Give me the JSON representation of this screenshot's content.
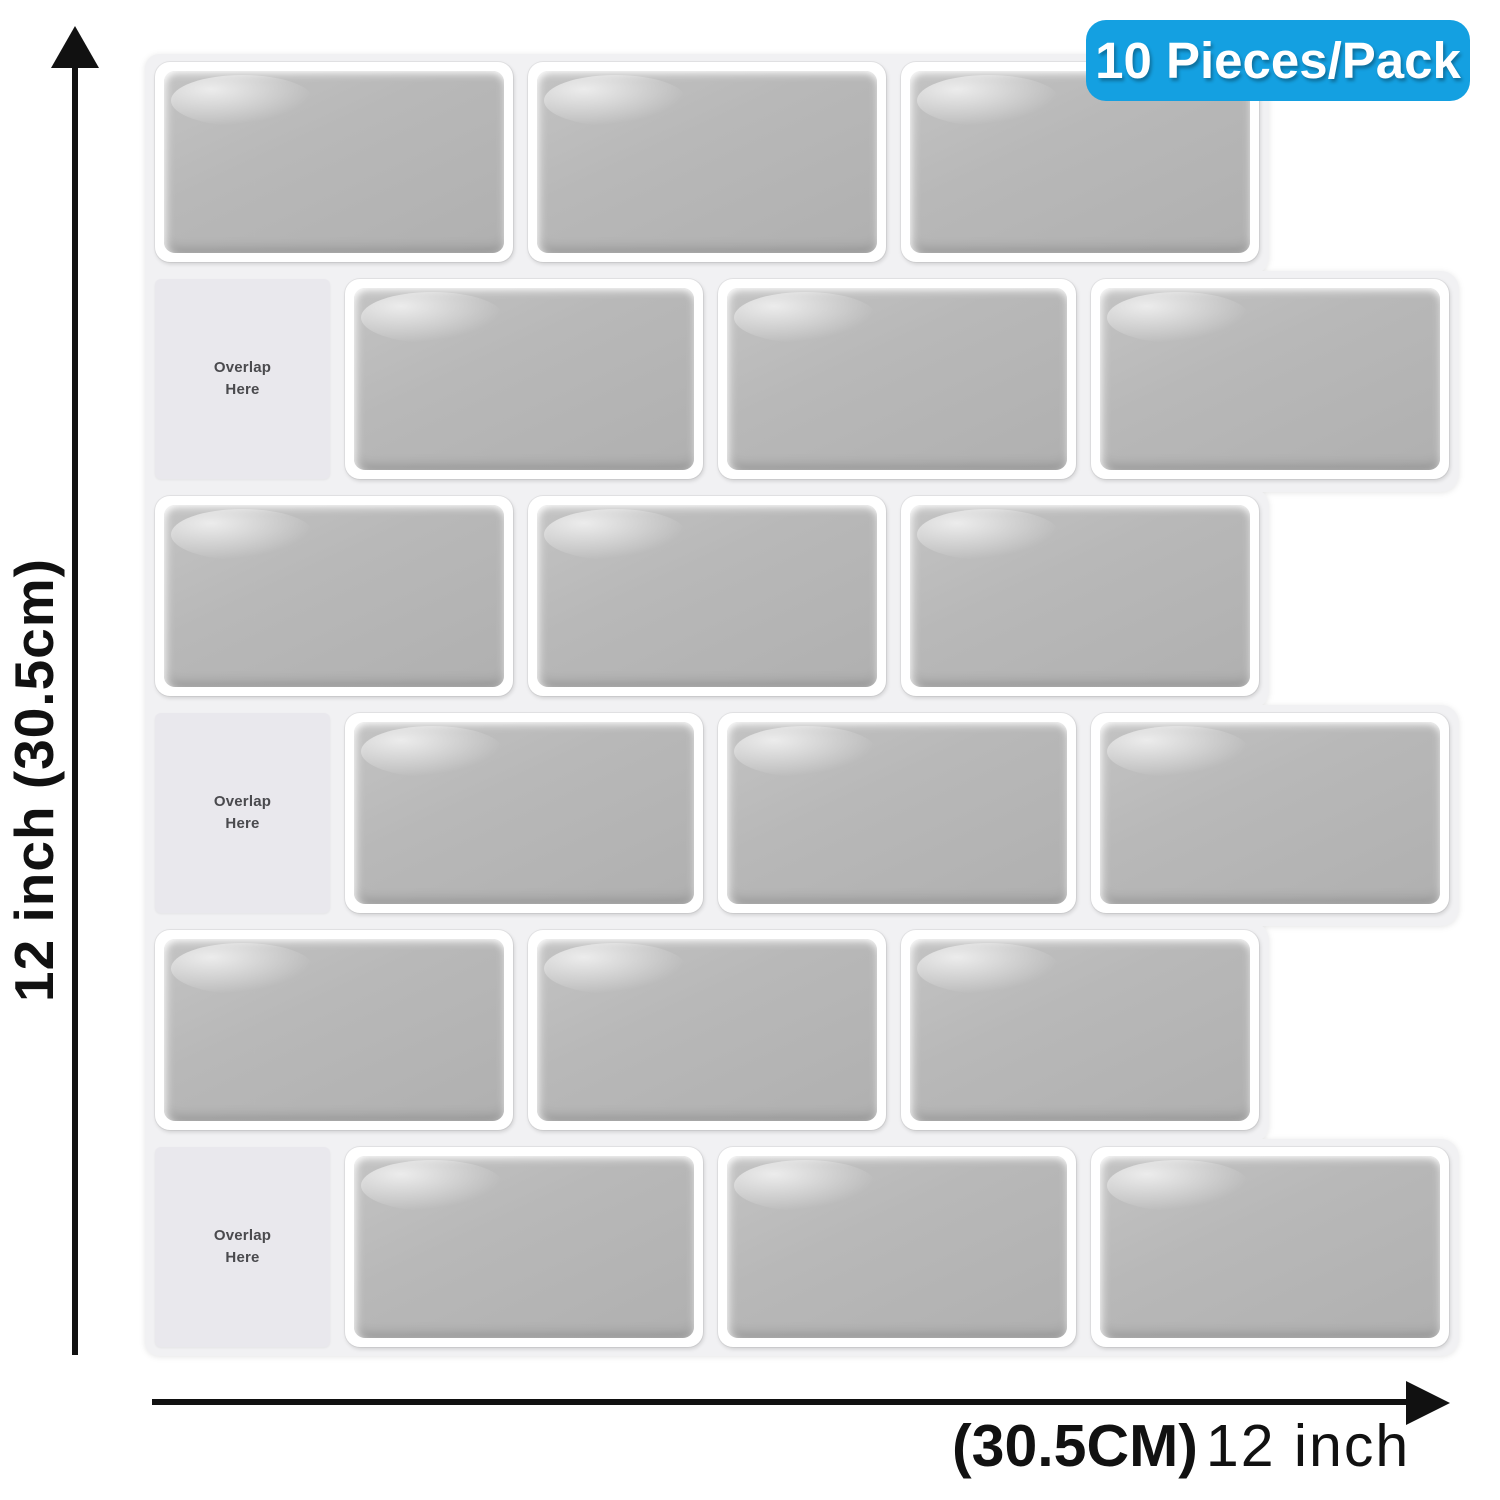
{
  "product_badge": {
    "label": "10 Pieces/Pack",
    "bg_color": "#14a0e1",
    "text_color": "#ffffff"
  },
  "dimension_annotations": {
    "vertical": {
      "label": "12 inch (30.5cm)"
    },
    "horizontal": {
      "label_metric": "(30.5CM)",
      "label_imperial": "12 inch"
    },
    "arrow_color": "#111111"
  },
  "tile_sheet": {
    "overlap_tile_label": "Overlap Here",
    "colors": {
      "grout": "#f1f1f3",
      "tile_fill": "#b8b8b8",
      "tile_rim": "#ffffff",
      "overlap_tile": "#e9e8ed",
      "overlap_text": "#4a4a4e"
    },
    "rows": [
      {
        "tiles": [
          "gray",
          "gray",
          "gray"
        ]
      },
      {
        "tiles": [
          "overlap",
          "gray",
          "gray",
          "gray"
        ]
      },
      {
        "tiles": [
          "gray",
          "gray",
          "gray"
        ]
      },
      {
        "tiles": [
          "overlap",
          "gray",
          "gray",
          "gray"
        ]
      },
      {
        "tiles": [
          "gray",
          "gray",
          "gray"
        ]
      },
      {
        "tiles": [
          "overlap",
          "gray",
          "gray",
          "gray"
        ]
      }
    ]
  }
}
